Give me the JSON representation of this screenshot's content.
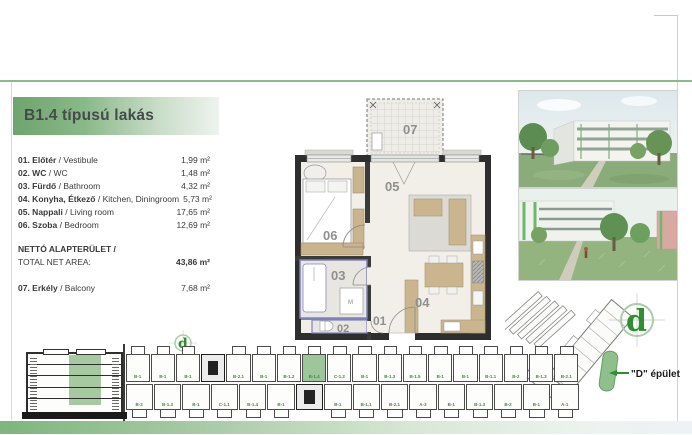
{
  "header": {
    "title": "B1.4 típusú lakás"
  },
  "colors": {
    "accent_green": "#6ea46d",
    "highlight_green": "#9dc69b",
    "unit_label_green": "#3f8f3f",
    "logo_green": "#2f8f2f"
  },
  "room_list": {
    "items": [
      {
        "label": "01. Előtér",
        "name_en": "/ Vestibule",
        "area": "1,99 m²"
      },
      {
        "label": "02. WC",
        "name_en": "/ WC",
        "area": "1,48 m²"
      },
      {
        "label": "03. Fürdő",
        "name_en": "/ Bathroom",
        "area": "4,32 m²"
      },
      {
        "label": "04. Konyha, Étkező",
        "name_en": "/ Kitchen, Diningroom",
        "area": "5,73 m²"
      },
      {
        "label": "05. Nappali",
        "name_en": "/ Living room",
        "area": "17,65 m²"
      },
      {
        "label": "06. Szoba",
        "name_en": "/ Bedroom",
        "area": "12,69 m²"
      }
    ],
    "total": {
      "label_hu": "NETTÓ ALAPTERÜLET /",
      "label_en": "TOTAL NET AREA:",
      "area": "43,86 m²"
    },
    "balcony": {
      "label": "07. Erkély",
      "name_en": "/ Balcony",
      "area": "7,68 m²"
    }
  },
  "floor_plan": {
    "labels": {
      "vestibule": "01",
      "wc": "02",
      "bathroom": "03",
      "kitchen": "04",
      "living": "05",
      "bedroom": "06",
      "balcony": "07"
    },
    "washer_mark": "M"
  },
  "site_plan": {
    "building_label": "\"D\" épület",
    "logo_char": "d"
  },
  "section": {
    "floors": 5
  },
  "floor_strip": {
    "top_units": [
      {
        "label": "B-1"
      },
      {
        "label": "B-1"
      },
      {
        "label": "B-1"
      },
      {
        "label": "",
        "type": "core"
      },
      {
        "label": "B-2.1"
      },
      {
        "label": "B-1"
      },
      {
        "label": "B-1.2"
      },
      {
        "label": "B-1.4",
        "highlight": true
      },
      {
        "label": "C-1.2"
      },
      {
        "label": "B-1"
      },
      {
        "label": "B-1.3"
      },
      {
        "label": "B-1.5"
      },
      {
        "label": "B-1"
      },
      {
        "label": "B-1"
      },
      {
        "label": "B-1.1"
      },
      {
        "label": "B-2"
      },
      {
        "label": "B-1.3"
      },
      {
        "label": "B-2.1"
      }
    ],
    "bottom_units": [
      {
        "label": "B-2"
      },
      {
        "label": "B-1.3"
      },
      {
        "label": "B-1"
      },
      {
        "label": "C-1.1"
      },
      {
        "label": "B-1.4"
      },
      {
        "label": "B-1"
      },
      {
        "label": "",
        "type": "core"
      },
      {
        "label": "B-1"
      },
      {
        "label": "B-1.1"
      },
      {
        "label": "B-2.1"
      },
      {
        "label": "A-3"
      },
      {
        "label": "B-1"
      },
      {
        "label": "B-1.3"
      },
      {
        "label": "B-2"
      },
      {
        "label": "B-1"
      },
      {
        "label": "A-1"
      }
    ]
  }
}
